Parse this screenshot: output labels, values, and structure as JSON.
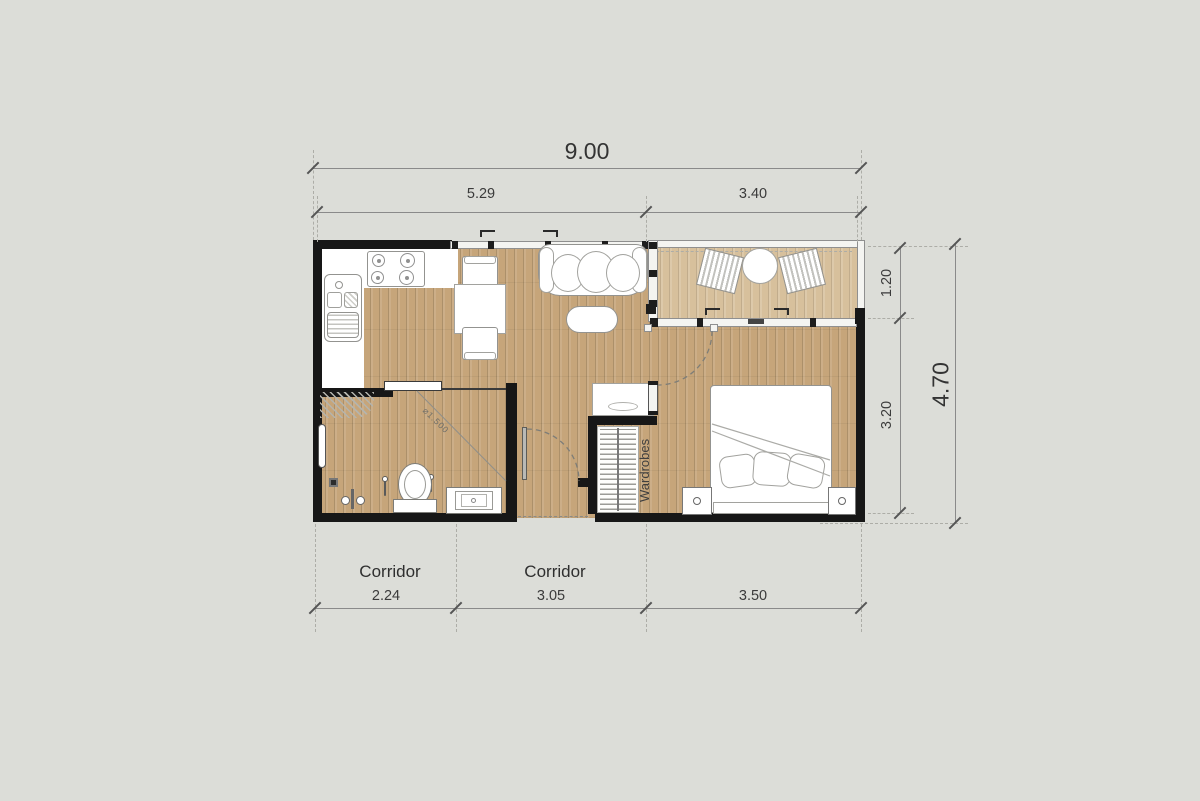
{
  "floorplan": {
    "dimensions": {
      "top_overall": "9.00",
      "top_segments": [
        "5.29",
        "3.40"
      ],
      "bottom_segments": [
        "2.24",
        "3.05",
        "3.50"
      ],
      "right_segments": [
        "1.20",
        "3.20"
      ],
      "right_overall": "4.70"
    },
    "labels": {
      "corridor_left": "Corridor",
      "corridor_center": "Corridor",
      "wardrobes": "Wardrobes",
      "slope_note": "⌀1.500"
    },
    "colors": {
      "background": "#dcddd8",
      "wall": "#171717",
      "floor_wood": "#c6a57a",
      "floor_plank_line": "#ad8a61",
      "balcony_floor": "#d7c09c",
      "furniture_fill": "#ffffff",
      "furniture_outline": "#939390",
      "dimension_line": "#8a8a8a",
      "dimension_text": "#3b3b3b"
    }
  }
}
